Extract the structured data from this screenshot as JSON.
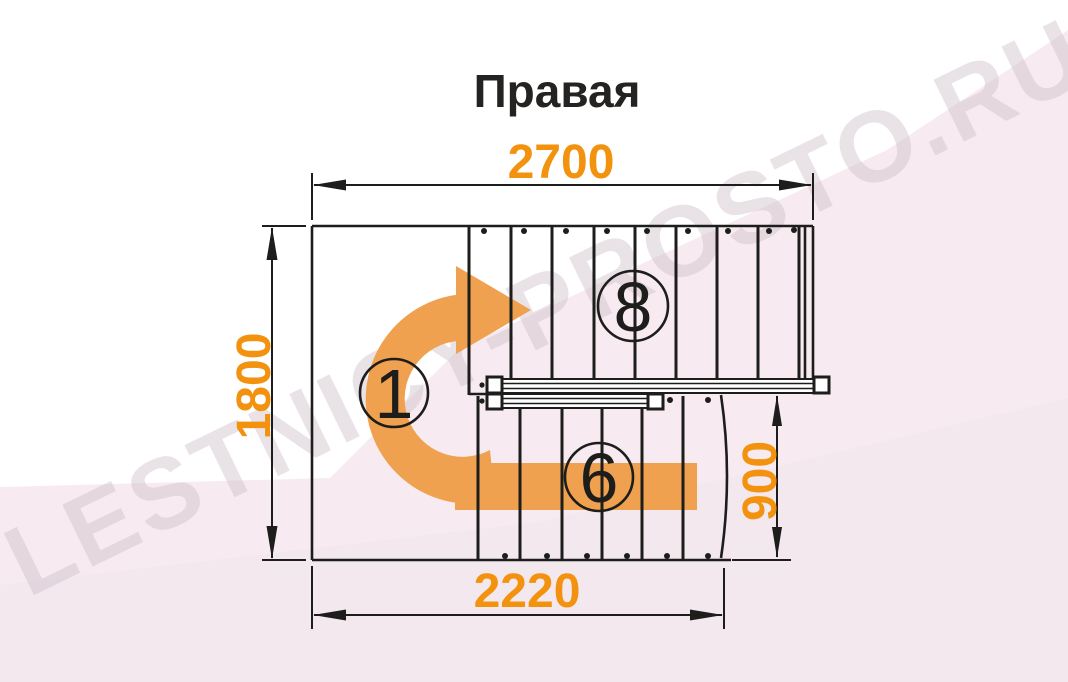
{
  "page": {
    "title": "Правая"
  },
  "watermark": {
    "text": "LESTNICY-PROSTO.RU"
  },
  "dimensions": {
    "top_width": "2700",
    "left_height": "1800",
    "right_height": "900",
    "bottom_width": "2220"
  },
  "step_labels": {
    "landing": "1",
    "upper_flight": "8",
    "lower_flight": "6"
  },
  "colors": {
    "accent_orange": "#F2920E",
    "arrow_orange": "#F0A14F",
    "line_black": "#1D1D1B",
    "background_pink": "#F7EBF1",
    "background_pink_deep": "#F3E5EC",
    "watermark_gray": "#C9BAC4",
    "title_black": "#242321"
  }
}
